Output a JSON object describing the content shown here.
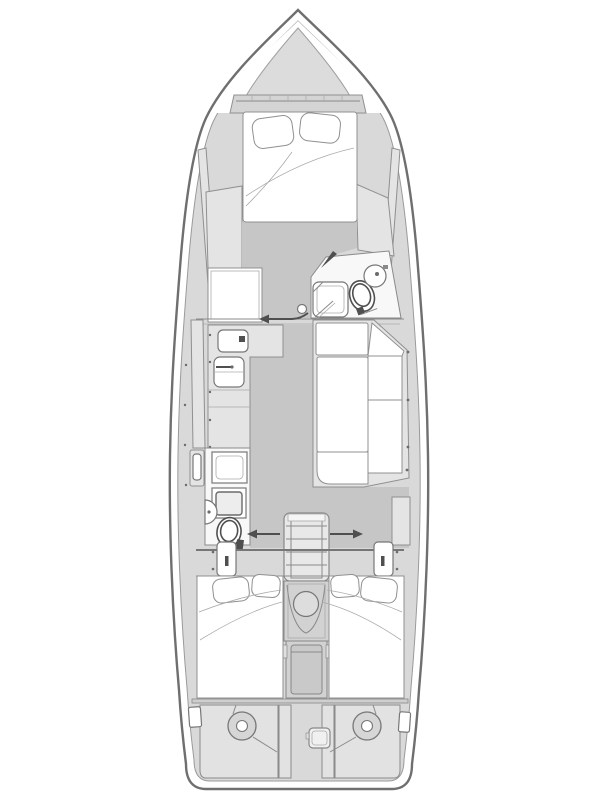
{
  "figure": {
    "type": "yacht-interior-floor-plan",
    "description": "Top-down interior layout drawing of a sailing yacht, bow pointing up",
    "orientation": "bow-up",
    "canvas": {
      "width": 600,
      "height": 800
    }
  },
  "colors": {
    "background": "#ffffff",
    "hull_outline": "#6f6f6f",
    "hull_inner_line": "#9a9a9a",
    "deck": "#d9d9d9",
    "floor": "#c6c6c6",
    "furniture": "#e4e4e4",
    "panel": "#e2e2e2",
    "cushion": "#ffffff",
    "dark": "#4f4f4f"
  },
  "compartments": [
    {
      "id": "bow-locker",
      "label": "Bow anchor locker / foredeck pad"
    },
    {
      "id": "forward-cabin",
      "label": "Forward cabin with V-berth double bed"
    },
    {
      "id": "forward-head",
      "label": "Forward head with shower, toilet and round washbasin"
    },
    {
      "id": "galley",
      "label": "Port galley with twin sinks and counters"
    },
    {
      "id": "saloon-settee",
      "label": "Starboard L-shaped saloon settee"
    },
    {
      "id": "aft-head",
      "label": "Port aft head with shower, washbasin and toilet"
    },
    {
      "id": "companionway",
      "label": "Companionway steps and engine compartment"
    },
    {
      "id": "port-aft-cabin",
      "label": "Port aft cabin with double berth"
    },
    {
      "id": "starboard-aft-cabin",
      "label": "Starboard aft cabin with double berth"
    },
    {
      "id": "stern-lazarette",
      "label": "Stern compartment with twin steering quadrants"
    }
  ],
  "fixtures": [
    "v-berth mattress with two pillows",
    "windlass step band with ticks",
    "port dresser / chart desk",
    "forward shower pan",
    "forward toilet",
    "round washbasin",
    "galley sink with drain",
    "galley double sink with faucet",
    "L-settee seat and back cushions",
    "companionway ladder with four treads",
    "engine hatch porthole",
    "aft shower pan",
    "aft half-round washbasin",
    "aft toilet",
    "port aft-cabin door with handle",
    "starboard aft-cabin door with handle",
    "twin aft berths with pillows",
    "twin steering quadrant discs",
    "emergency tiller access plate",
    "stern side pockets"
  ],
  "annotations": {
    "arrows": [
      {
        "id": "forward-cabin-entry",
        "direction": "left",
        "y": 319
      },
      {
        "id": "port-aft-entry",
        "direction": "left",
        "y": 534
      },
      {
        "id": "starboard-aft-entry",
        "direction": "right",
        "y": 534
      }
    ]
  }
}
